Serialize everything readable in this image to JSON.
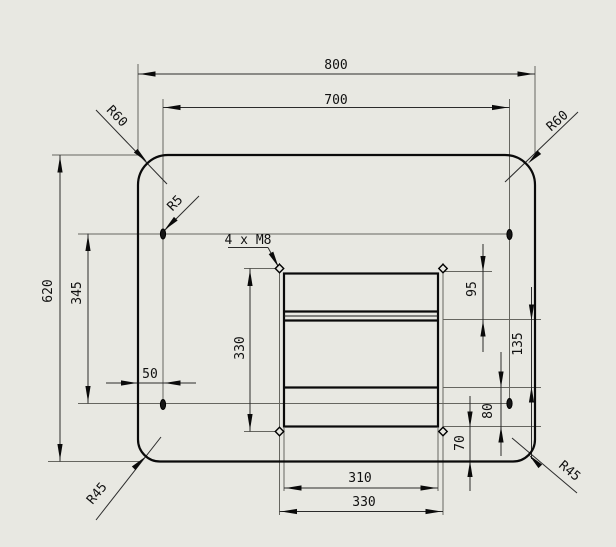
{
  "drawing": {
    "kind": "technical-dimension-drawing",
    "background_color": "#e8e8e2",
    "line_color": "#0a0a0a",
    "labels": {
      "dim_800": "800",
      "dim_700": "700",
      "dim_620": "620",
      "dim_345": "345",
      "dim_330_vertical": "330",
      "dim_50": "50",
      "dim_95": "95",
      "dim_135": "135",
      "dim_80": "80",
      "dim_70": "70",
      "dim_310": "310",
      "dim_330_bottom": "330",
      "radius_top_left": "R60",
      "radius_top_right": "R60",
      "radius_bottom_left": "R45",
      "radius_bottom_right": "R45",
      "radius_small_hole": "R5",
      "hole_callout": "4 x M8"
    }
  }
}
